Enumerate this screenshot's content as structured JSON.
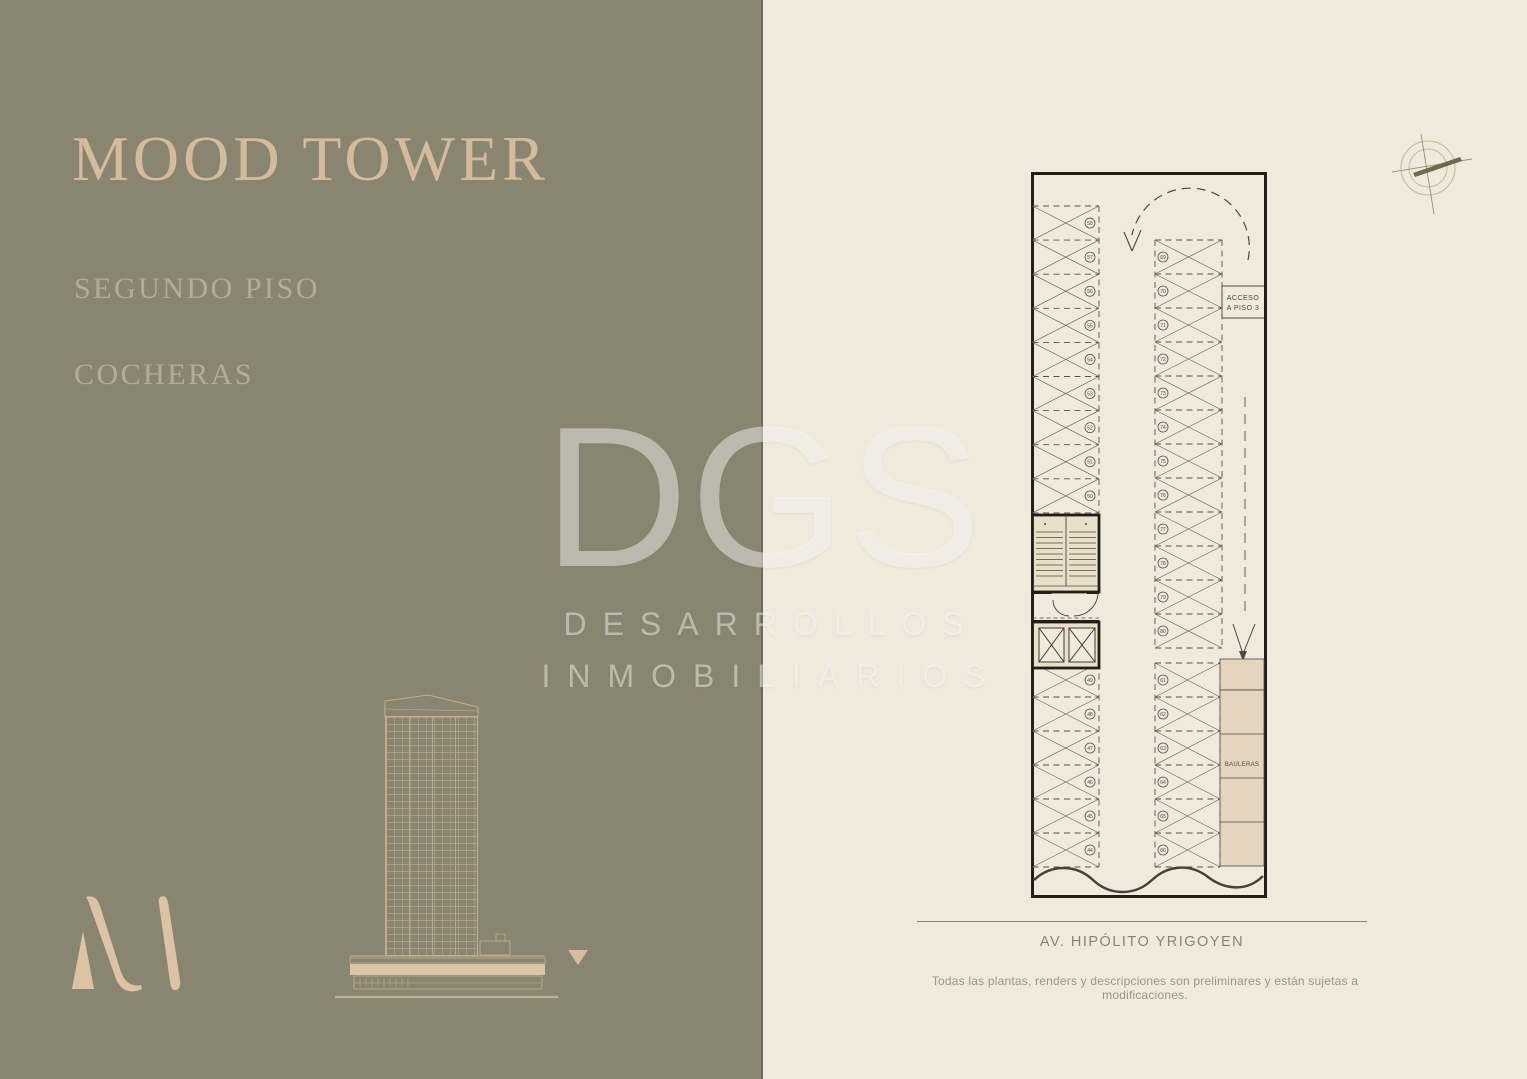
{
  "page": {
    "title": "MOOD TOWER",
    "subtitle_floor": "SEGUNDO PISO",
    "subtitle_type": "COCHERAS"
  },
  "watermark": {
    "logo": "DGS",
    "line1": "DESARROLLOS",
    "line2": "INMOBILIARIOS"
  },
  "plan": {
    "access_label": [
      "ACCESO",
      "A PISO 3"
    ],
    "bauleras_label": "BAULERAS",
    "street_label": "AV. HIPÓLITO YRIGOYEN",
    "disclaimer": "Todas las plantas, renders y descripciones son preliminares y están sujetas a modificaciones.",
    "parking_numbers": {
      "left_upper": [
        "58",
        "57",
        "56",
        "55",
        "54",
        "53",
        "52",
        "51",
        "50"
      ],
      "right_upper": [
        "69",
        "70",
        "71",
        "72",
        "73",
        "74",
        "75",
        "76",
        "77",
        "78",
        "79",
        "80"
      ],
      "left_lower": [
        "49",
        "48",
        "47",
        "46",
        "45",
        "44"
      ],
      "right_lower": [
        "61",
        "62",
        "63",
        "64",
        "65",
        "66"
      ]
    }
  },
  "colors": {
    "panel_green": "#8a8570",
    "panel_cream": "#f1e9dc",
    "title_beige": "#d5bb9d",
    "subtitle_beige": "#b5ac97",
    "logo_beige": "#dcc3a6",
    "plan_line": "#55504a",
    "plan_wall": "#211d17",
    "plan_shade": "#e4d6be"
  }
}
